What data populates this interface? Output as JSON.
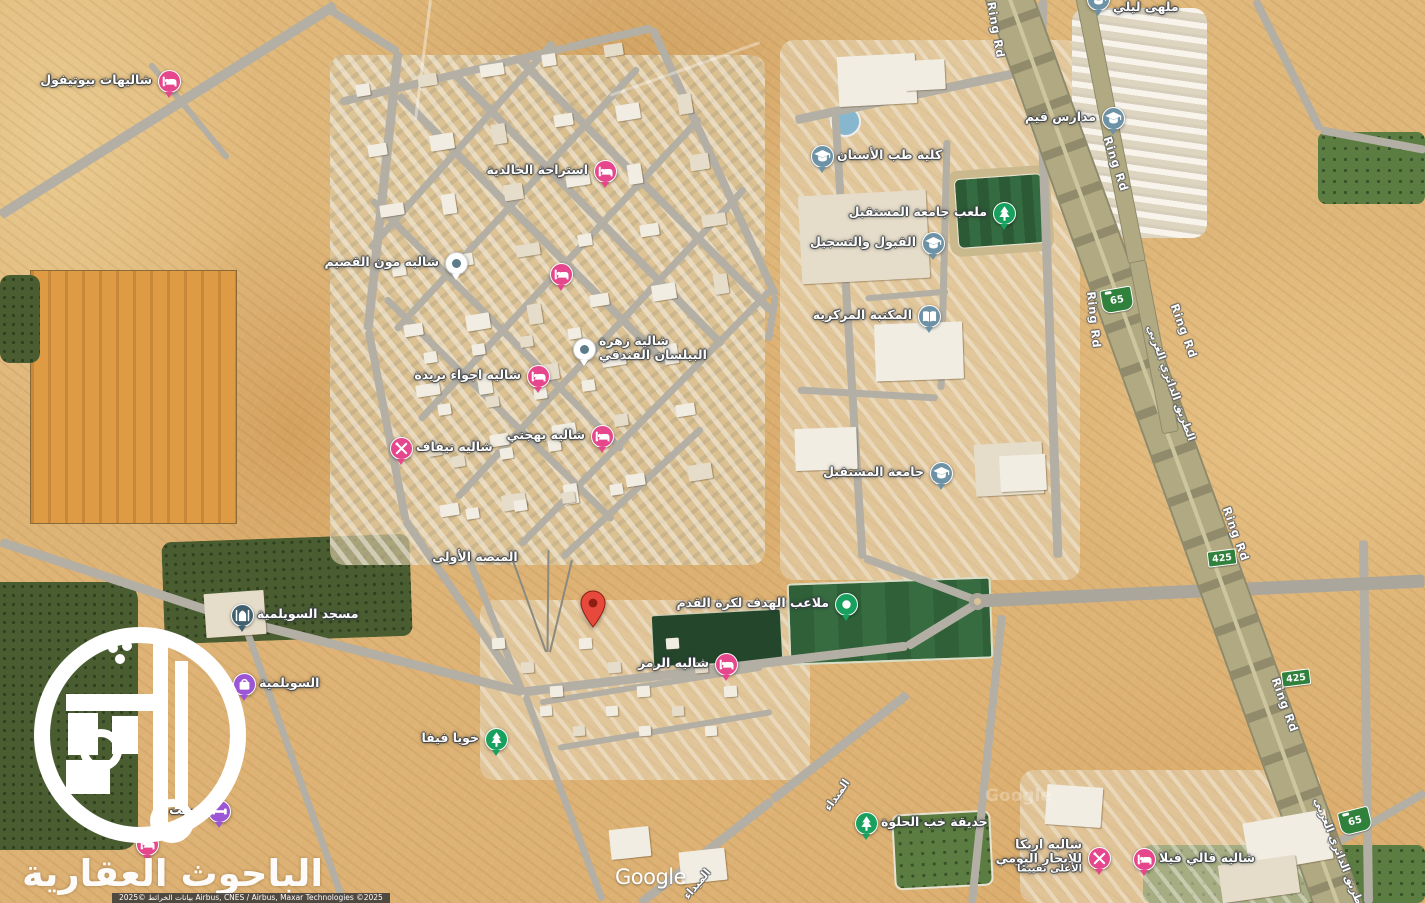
{
  "map": {
    "watermark_brand": "الباحوث العقارية",
    "google_logo": "Google",
    "attribution": "بيانات الخرائط ©2025 Airbus, CNES / Airbus, Maxar Technologies ©2025"
  },
  "colors": {
    "lodging_pink": "#e5468c",
    "school_slate": "#6e92a5",
    "park_green": "#17a05e",
    "mosque_slate": "#40606e",
    "shopping_purple": "#9c55d4",
    "red_marker": "#e74a3c",
    "red_marker_dark": "#8e1d12",
    "white_marker_dot": "#5d7c8a",
    "shield_green": "#2f813c"
  },
  "markers": [
    {
      "name": "chalets-beautiful",
      "icon": "bed",
      "x": 168,
      "y": 80,
      "side": "left",
      "lines": [
        "شاليهات بيوتيفول"
      ]
    },
    {
      "name": "istiraha-khalidiya",
      "icon": "bed",
      "x": 604,
      "y": 170,
      "side": "left",
      "lines": [
        "استراحة الخالدية"
      ]
    },
    {
      "name": "lodging-unlabeled",
      "icon": "bed",
      "x": 560,
      "y": 273,
      "side": "none",
      "lines": []
    },
    {
      "name": "chalet-moon-qassim",
      "icon": "whitedot",
      "x": 455,
      "y": 262,
      "side": "left",
      "lines": [
        "شاليه مون القصيم"
      ]
    },
    {
      "name": "zahrat-bilasan-hotel",
      "icon": "whitedot",
      "x": 583,
      "y": 348,
      "side": "right",
      "lines": [
        "شالية زهرة",
        "البيلسان الفندقي"
      ]
    },
    {
      "name": "chalet-ajwaa-buraidah",
      "icon": "bed",
      "x": 537,
      "y": 375,
      "side": "left",
      "lines": [
        "شاليه اجواء بريدة"
      ]
    },
    {
      "name": "chalet-bahjati",
      "icon": "bed",
      "x": 601,
      "y": 435,
      "side": "left",
      "lines": [
        "شاليه بهجتي"
      ]
    },
    {
      "name": "chalet-tifaf",
      "icon": "tools",
      "x": 400,
      "y": 447,
      "side": "right",
      "lines": [
        "شاليه تيفاف"
      ]
    },
    {
      "name": "first-platform",
      "icon": "none",
      "x": 475,
      "y": 557,
      "side": "none",
      "lines": [
        "المنصة الأولى"
      ]
    },
    {
      "name": "suwailimiya-mosque",
      "icon": "mosque",
      "x": 241,
      "y": 614,
      "side": "right",
      "lines": [
        "مسجد السويلمية"
      ]
    },
    {
      "name": "suwailimiya",
      "icon": "shop",
      "x": 243,
      "y": 683,
      "side": "right",
      "lines": [
        "السويلمية"
      ]
    },
    {
      "name": "khoya-fifa",
      "icon": "tree",
      "x": 495,
      "y": 738,
      "side": "left",
      "lines": [
        "خويا فيفا"
      ]
    },
    {
      "name": "alhadaf-football-fields",
      "icon": "dot",
      "x": 845,
      "y": 603,
      "side": "left",
      "lines": [
        "ملاعب الهدف لكرة القدم"
      ]
    },
    {
      "name": "chalet-alramz",
      "icon": "bed",
      "x": 725,
      "y": 663,
      "side": "left",
      "lines": [
        "شاليه الرمز"
      ]
    },
    {
      "name": "khab-alhalwa-garden",
      "icon": "tree",
      "x": 865,
      "y": 822,
      "side": "right",
      "lines": [
        "حديقة خب الحلوة"
      ]
    },
    {
      "name": "chalet-areca",
      "icon": "tools",
      "x": 1098,
      "y": 857,
      "side": "left",
      "small_last": true,
      "lines": [
        "شاليه اريكا",
        "للايجار اليومي",
        "الأعلى تقييمًا"
      ]
    },
    {
      "name": "chalet-qali-villa",
      "icon": "bed",
      "x": 1143,
      "y": 858,
      "side": "right",
      "lines": [
        "شاليه قالي فيلا"
      ]
    },
    {
      "name": "qeem-schools",
      "icon": "grad",
      "x": 1112,
      "y": 117,
      "side": "left",
      "lines": [
        "مدارس قيم"
      ]
    },
    {
      "name": "dental-college",
      "icon": "grad",
      "x": 821,
      "y": 155,
      "side": "right",
      "lines": [
        "كلية طب الأسنان"
      ]
    },
    {
      "name": "future-university-stadium",
      "icon": "tree",
      "x": 1003,
      "y": 212,
      "side": "left",
      "lines": [
        "ملعب جامعة المستقبل"
      ]
    },
    {
      "name": "admission-registration",
      "icon": "grad",
      "x": 932,
      "y": 242,
      "side": "left",
      "lines": [
        "القبول والتسجيل"
      ]
    },
    {
      "name": "central-library",
      "icon": "book",
      "x": 928,
      "y": 315,
      "side": "left",
      "lines": [
        "المكتبة المركزية"
      ]
    },
    {
      "name": "future-university",
      "icon": "grad",
      "x": 940,
      "y": 472,
      "side": "left",
      "lines": [
        "جامعة المستقبل"
      ]
    },
    {
      "name": "night-club-partial",
      "icon": "grad",
      "x": 1097,
      "y": -2,
      "side": "right",
      "ldy": 9,
      "lines": [
        "ملهى ليلي"
      ]
    },
    {
      "name": "gym-partial",
      "icon": "gym",
      "x": 218,
      "y": 810,
      "side": "left",
      "lines": [
        "زولت"
      ]
    },
    {
      "name": "pin-under-watermark",
      "icon": "bed",
      "x": 146,
      "y": 843,
      "side": "none",
      "under": true,
      "lines": []
    },
    {
      "name": "dropped-pin",
      "icon": "redpin",
      "x": 593,
      "y": 627,
      "side": "none",
      "lines": []
    }
  ],
  "road_labels": [
    {
      "text": "Ring Rd",
      "x": 996,
      "y": 30,
      "rot": 80
    },
    {
      "text": "Ring Rd",
      "x": 1116,
      "y": 164,
      "rot": 72
    },
    {
      "text": "Ring Rd",
      "x": 1094,
      "y": 320,
      "rot": 84
    },
    {
      "text": "Ring Rd",
      "x": 1184,
      "y": 331,
      "rot": 70
    },
    {
      "text": "الطريق الدائري الغربي",
      "x": 1171,
      "y": 383,
      "rot": 70
    },
    {
      "text": "Ring Rd",
      "x": 1236,
      "y": 534,
      "rot": 70
    },
    {
      "text": "Ring Rd",
      "x": 1285,
      "y": 705,
      "rot": 70
    },
    {
      "text": "الطريق الدائري الغربي",
      "x": 1340,
      "y": 855,
      "rot": 68
    },
    {
      "text": "الميداء",
      "x": 837,
      "y": 795,
      "rot": -55
    },
    {
      "text": "الميداء",
      "x": 697,
      "y": 884,
      "rot": -50
    }
  ],
  "route_shields": [
    {
      "number": "65",
      "style": "hwy65",
      "x": 1117,
      "y": 300,
      "rot": -10
    },
    {
      "number": "65",
      "style": "hwy65",
      "x": 1355,
      "y": 821,
      "rot": -14
    },
    {
      "number": "425",
      "style": "box",
      "x": 1222,
      "y": 558,
      "rot": -7
    },
    {
      "number": "425",
      "style": "box",
      "x": 1296,
      "y": 678,
      "rot": -7
    }
  ]
}
